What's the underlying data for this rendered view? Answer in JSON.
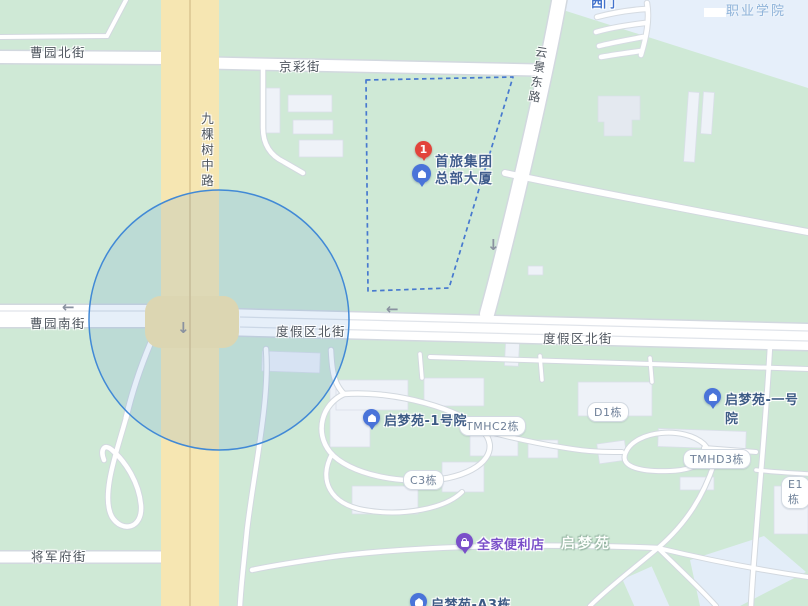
{
  "marker": {
    "badge": "1",
    "name_line1": "首旅集团",
    "name_line2": "总部大厦"
  },
  "streets": {
    "caoyuan_north": "曹园北街",
    "jingcai": "京彩街",
    "jiukeshu_middle": "九棵树中路",
    "yunjing_east": "云景东路",
    "caoyuan_south": "曹园南街",
    "dujiaqu_north_west": "度假区北街",
    "dujiaqu_north_east": "度假区北街",
    "jiangjunfu": "将军府街"
  },
  "areas": {
    "vocational_college": "职业学院",
    "west_gate": "西门",
    "qimengyuan": "启梦苑"
  },
  "pois": {
    "qimengyuan_yard1": "启梦苑-1号院",
    "qimengyuan_yard1_alt": "启梦苑-一号院",
    "familymart": "全家便利店",
    "qimengyuan_a3": "启梦苑-A3栋"
  },
  "buildings": {
    "tmhc2": "TMHC2栋",
    "c3": "C3栋",
    "d1": "D1栋",
    "tmhd3": "TMHD3栋",
    "e1": "E1栋"
  },
  "arrows": {
    "left1": "←",
    "down1": "↓",
    "left2": "←",
    "down2": "↓"
  },
  "colors": {
    "map_green": "#cfe9d6",
    "campus_blue": "#e6effa",
    "road_yellow": "#f6e6b2",
    "road_white": "#ffffff",
    "accuracy_circle_stroke": "#4189d6",
    "boundary_dash_blue": "#4779cf",
    "marker_red": "#e2443b",
    "poi_pin_blue": "#4a74d9",
    "poi_text_blue": "#3d5b85",
    "store_purple": "#7a4fc9",
    "street_text": "#4e555e",
    "campus_text": "#8fb3d9"
  }
}
